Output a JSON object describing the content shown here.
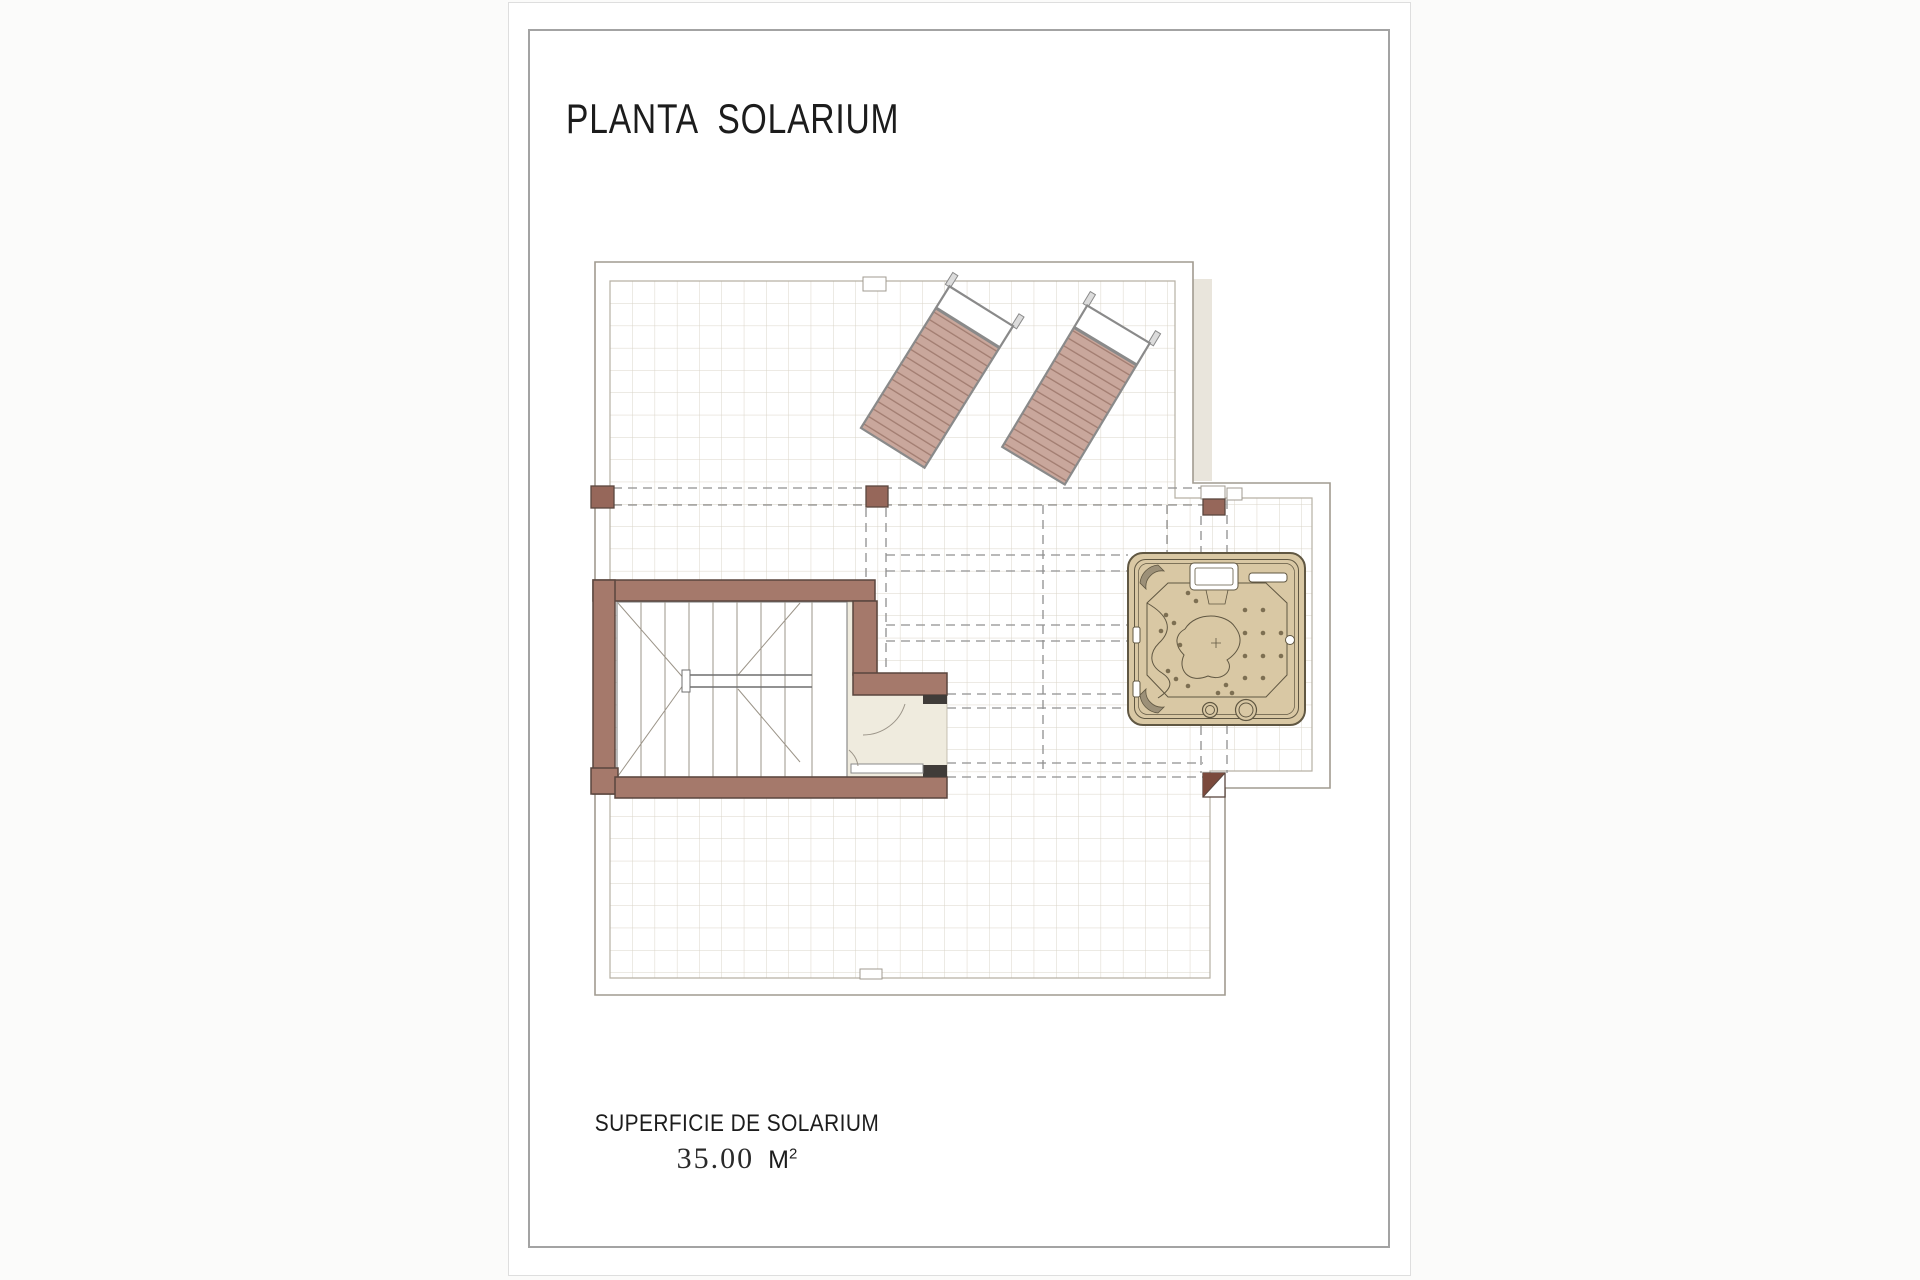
{
  "page": {
    "title": "PLANTA  SOLARIUM"
  },
  "area": {
    "label": "SUPERFICIE DE SOLARIUM",
    "value": "35.00",
    "unit_base": "M",
    "unit_sup": "2"
  },
  "plan": {
    "elements": [
      "roof-terrace-outline",
      "tile-grid",
      "pergola-dashed-beams",
      "sun-lounger-left",
      "sun-lounger-right",
      "staircase",
      "stair-door",
      "jacuzzi",
      "pillars"
    ]
  },
  "colors": {
    "ink": "#1c1c1c",
    "sheet-edge": "#dedede",
    "frame": "#a3a3a3",
    "boundary": "#a19b90",
    "boundary-inner": "#b6b0a4",
    "grid": "#dad4c8",
    "beige": "#e9e5dc",
    "dash": "#8f8f8f",
    "wall": "#a5796b",
    "wall-border": "#5a463e",
    "wall-dark": "#7b4a3c",
    "pillar": "#96675a",
    "jamb": "#403c39",
    "cream": "#efebde",
    "stairline": "#9b9488",
    "lounger": "#c9a79c",
    "lounger-line": "#a27d71",
    "lounger-border": "#8a8a8a",
    "tub": "#d9c8a4",
    "tub-line": "#605742"
  }
}
